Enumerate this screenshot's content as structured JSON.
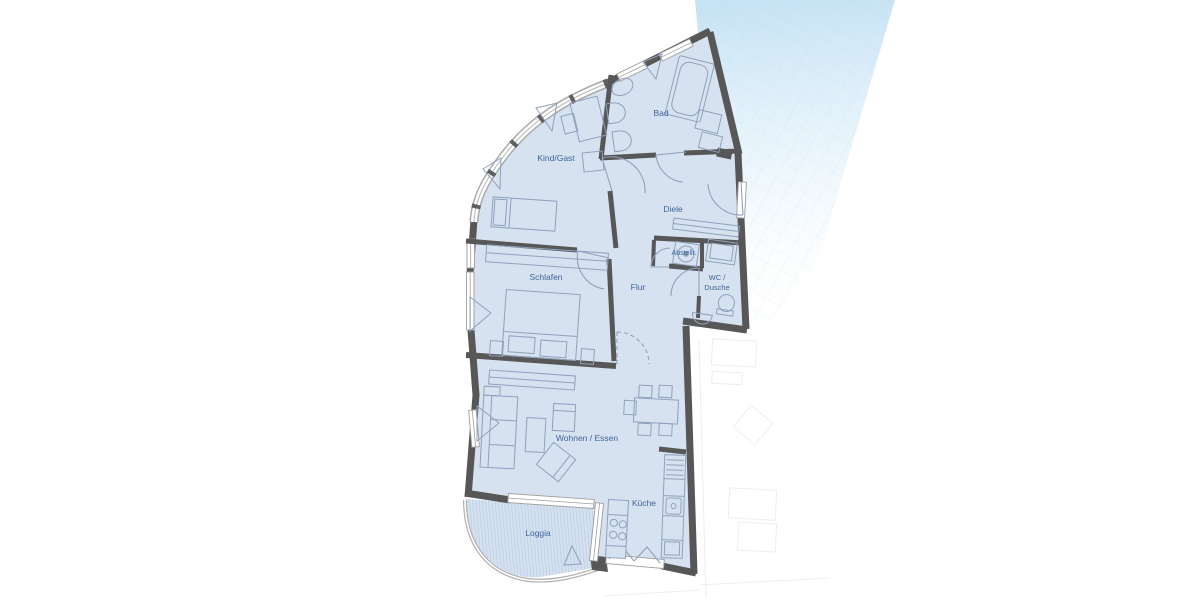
{
  "meta": {
    "type": "apartment-floor-plan",
    "language": "de"
  },
  "colors": {
    "room_fill": "#d7e2f0",
    "wall": "#575757",
    "furniture_stroke": "#8fa1bd",
    "label": "#3d6599",
    "window_frame": "#9e9e9e",
    "glazing": "#b5b5b5",
    "loggia_stripe": "#bccfe5",
    "band_blue": "#c9e4f4",
    "neighbor": "#dce3ee"
  },
  "rooms": [
    {
      "id": "kind-gast",
      "label": "Kind/Gast"
    },
    {
      "id": "bad",
      "label": "Bad"
    },
    {
      "id": "diele",
      "label": "Diele"
    },
    {
      "id": "schlafen",
      "label": "Schlafen"
    },
    {
      "id": "flur",
      "label": "Flur"
    },
    {
      "id": "abstellraum",
      "label": "Abstellr."
    },
    {
      "id": "wc-dusche",
      "label": "WC /",
      "label2": "Dusche"
    },
    {
      "id": "wohnen-essen",
      "label": "Wohnen / Essen"
    },
    {
      "id": "kueche",
      "label": "Küche"
    },
    {
      "id": "loggia",
      "label": "Loggia"
    }
  ]
}
